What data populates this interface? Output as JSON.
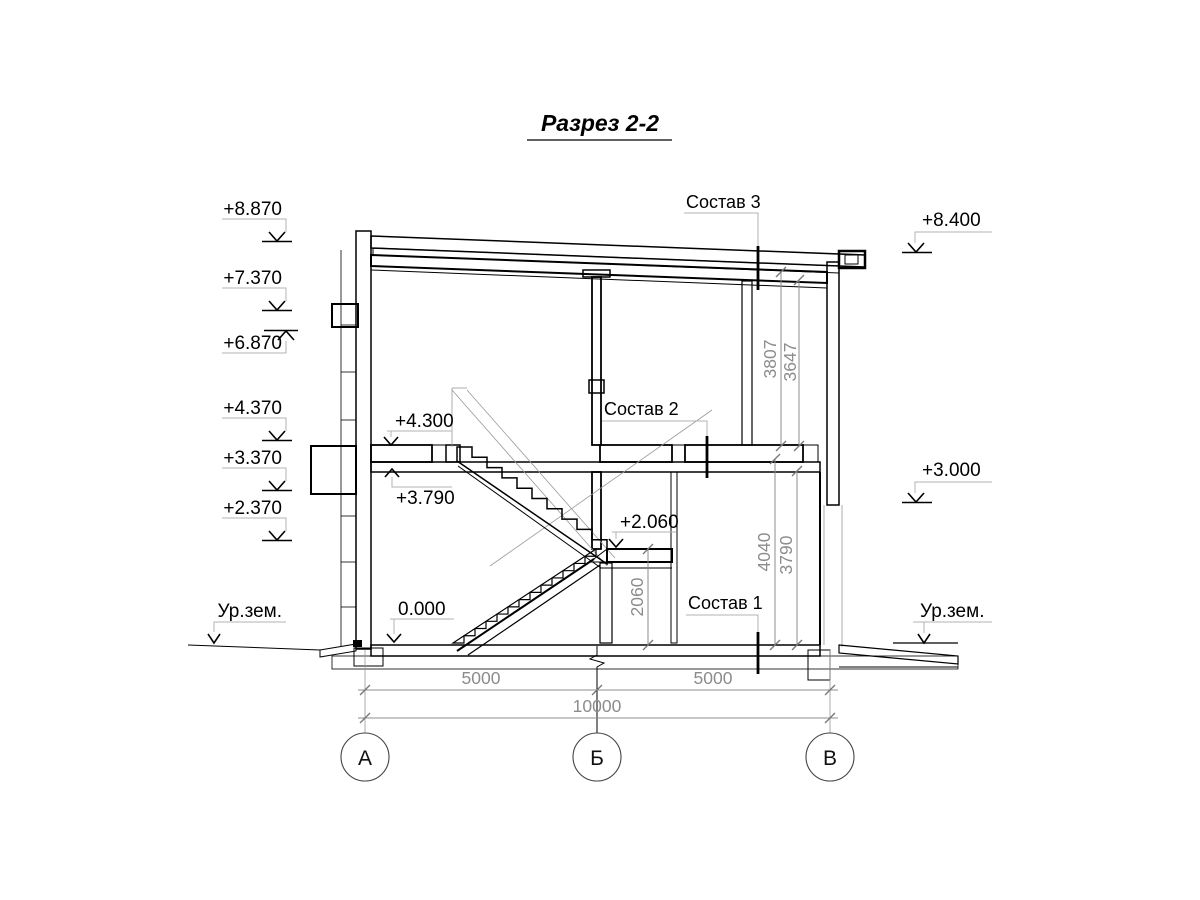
{
  "title": "Разрез 2-2",
  "elevations": {
    "left": [
      "+8.870",
      "+7.370",
      "+6.870",
      "+4.370",
      "+3.370",
      "+2.370"
    ],
    "ground_left": "Ур.зем.",
    "right": [
      "+8.400",
      "+3.000"
    ],
    "ground_right": "Ур.зем.",
    "interior": {
      "floor2_top": "+4.300",
      "floor2_soffit": "+3.790",
      "landing": "+2.060",
      "floor1": "0.000"
    }
  },
  "layer_labels": {
    "roof": "Состав 3",
    "floor2": "Состав 2",
    "floor1": "Состав 1"
  },
  "dimensions": {
    "storey2_clear": [
      "3807",
      "3647"
    ],
    "storey1_clear": [
      "4040",
      "3790"
    ],
    "landing_height": "2060",
    "spans": [
      "5000",
      "5000"
    ],
    "total_span": "10000"
  },
  "axes": [
    "А",
    "Б",
    "В"
  ],
  "colors": {
    "line": "#000000",
    "dim_gray": "#8c8c8c",
    "shelf_gray": "#b3b3b3"
  }
}
